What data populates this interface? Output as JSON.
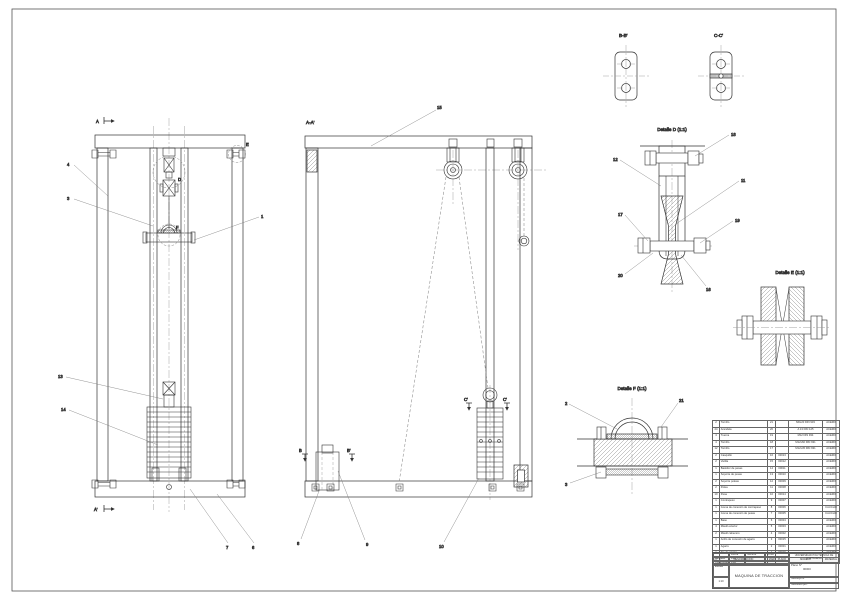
{
  "views": {
    "titles": {
      "aa": "A-A'",
      "bb": "B-B'",
      "cc": "C-C'",
      "detail_d": "Detalle D (1:1)",
      "detail_e": "Detalle E (1:1)",
      "detail_f": "Detalle F (1:1)"
    },
    "marks": {
      "a": "A",
      "a2": "A'",
      "b": "B",
      "b2": "B'",
      "c": "C'",
      "c2": "C'",
      "d": "D",
      "e": "E",
      "f": "F"
    }
  },
  "callouts": {
    "n1": "1",
    "n2": "2",
    "n3": "3",
    "n4": "4",
    "n6": "6",
    "n7": "7",
    "n8": "8",
    "n9": "9",
    "n10": "10",
    "n11": "11",
    "n12": "12",
    "n13": "13",
    "n14": "14",
    "n15": "15",
    "n16": "16",
    "n17": "17",
    "n18": "18",
    "n19": "19",
    "n20": "20",
    "n21": "21"
  },
  "bom": {
    "headers": [
      "Nº",
      "DENOMINACIÓN",
      "MARCA",
      "PLANO",
      "MODELO",
      "MATERIAL"
    ],
    "rows": [
      [
        "2",
        "Tornillo",
        "21",
        "",
        "M6x20 DIN 933",
        "ACERO"
      ],
      [
        "24",
        "Arandela",
        "20",
        "",
        "A 13 DIN 125",
        "ACERO"
      ],
      [
        "4",
        "Tuerca",
        "19",
        "",
        "M12 DIN 934",
        "ACERO"
      ],
      [
        "4",
        "Tornillo",
        "18",
        "",
        "M12x60 DIN 931",
        "ACERO"
      ],
      [
        "12",
        "Tornillo",
        "17",
        "",
        "M12x45 DIN 931",
        "ACERO"
      ],
      [
        "2",
        "Casquillo",
        "16",
        "00013",
        "",
        "ACERO"
      ],
      [
        "2",
        "Varilla",
        "15",
        "00012",
        "",
        "ACERO"
      ],
      [
        "1",
        "Bastidor de pesas",
        "14",
        "00011",
        "",
        "ACERO"
      ],
      [
        "1",
        "Soporte de pesas",
        "13",
        "00010",
        "",
        "ACERO"
      ],
      [
        "2",
        "Soporte poleas",
        "12",
        "00009",
        "",
        "ACERO"
      ],
      [
        "2",
        "Polea",
        "11",
        "00008",
        "",
        "ACERO"
      ],
      [
        "10",
        "Pesa",
        "10",
        "00014",
        "",
        "ACERO"
      ],
      [
        "1",
        "Contrapeso",
        "9",
        "00007",
        "",
        "ACERO"
      ],
      [
        "1",
        "Goma de conexión de contrapeso",
        "8",
        "00006",
        "",
        "CAUCHO"
      ],
      [
        "1",
        "Goma de conexión de pesas",
        "7",
        "00005",
        "",
        "CAUCHO"
      ],
      [
        "1",
        "Base",
        "6",
        "00004",
        "",
        "ACERO"
      ],
      [
        "4",
        "Mástil exterior",
        "5",
        "00003",
        "",
        "ACERO"
      ],
      [
        "2",
        "Mástil cabecero",
        "4",
        "00002",
        "",
        "ACERO"
      ],
      [
        "1",
        "Anillo de conexión de agarre",
        "3",
        "00015",
        "",
        "ACERO"
      ],
      [
        "1",
        "Agarre",
        "2",
        "00001",
        "",
        "ACERO"
      ],
      [
        "1",
        "Eje de agarre",
        "1",
        "00016",
        "",
        "ACERO"
      ]
    ]
  },
  "title_block": {
    "labels": {
      "fecha": "Fecha",
      "nombre": "Nombre",
      "firma": "Firma",
      "dibujado": "Dibujado",
      "comprobado": "Comprobado",
      "escala": "Escala",
      "plano_no": "Plano Nº",
      "sustituye": "Sustituye a:",
      "sustituido": "Sustituido por:"
    },
    "values": {
      "dibujado_fecha": "14/8",
      "comprobado_fecha": "14/8",
      "escala": "1:10",
      "plano_no": "00000",
      "universidad": "UNIVERSIDAD POLITÉCNICA DE CARTAGENA",
      "titulo": "MAQUINA DE TRACCION"
    }
  }
}
